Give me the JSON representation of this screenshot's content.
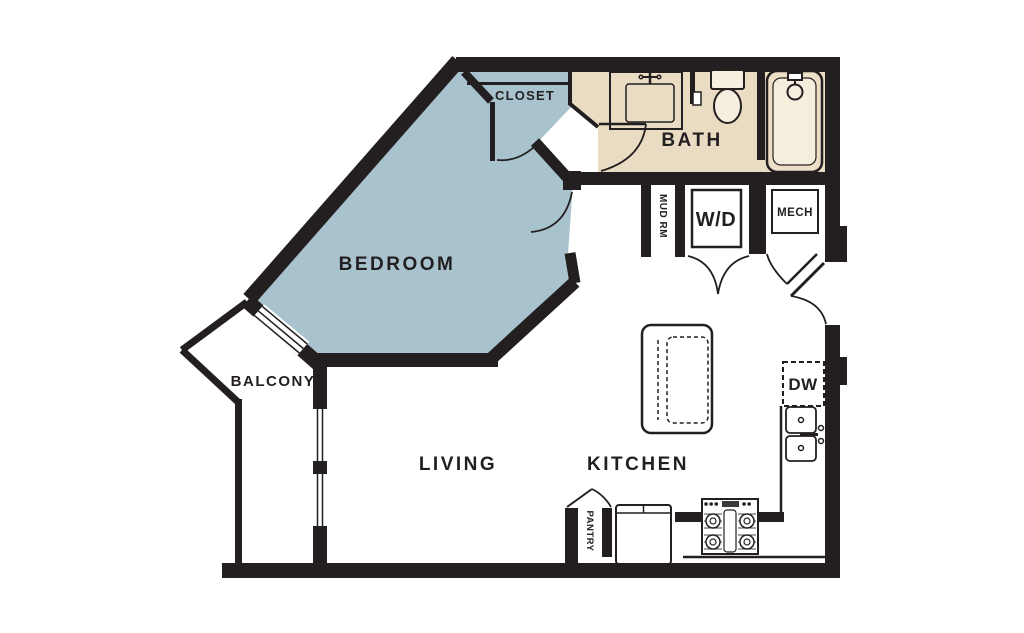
{
  "title": "One-bedroom apartment floor plan",
  "colors": {
    "bedroom_fill": "#a8c3ce",
    "bath_fill": "#e9dcc3",
    "tub_fill": "#ecdfc6",
    "tub_inner_fill": "#f6eedd",
    "fixture_fill": "#f6efe0",
    "wall": "#231f20",
    "background": "#ffffff"
  },
  "rooms": {
    "bedroom": "BEDROOM",
    "closet": "CLOSET",
    "bath": "BATH",
    "balcony": "BALCONY",
    "living": "LIVING",
    "kitchen": "KITCHEN"
  },
  "utility": {
    "mud_room": "MUD RM",
    "washer_dryer": "W/D",
    "mechanical": "MECH",
    "dishwasher": "DW",
    "pantry": "PANTRY"
  },
  "fixtures": [
    "vanity-sink",
    "toilet",
    "bathtub",
    "washer-dryer-closet",
    "mech-closet",
    "kitchen-island",
    "dishwasher",
    "double-kitchen-sink",
    "stove",
    "refrigerator",
    "pantry-closet",
    "sliding-glass-door",
    "balcony-windows",
    "entry-door"
  ]
}
